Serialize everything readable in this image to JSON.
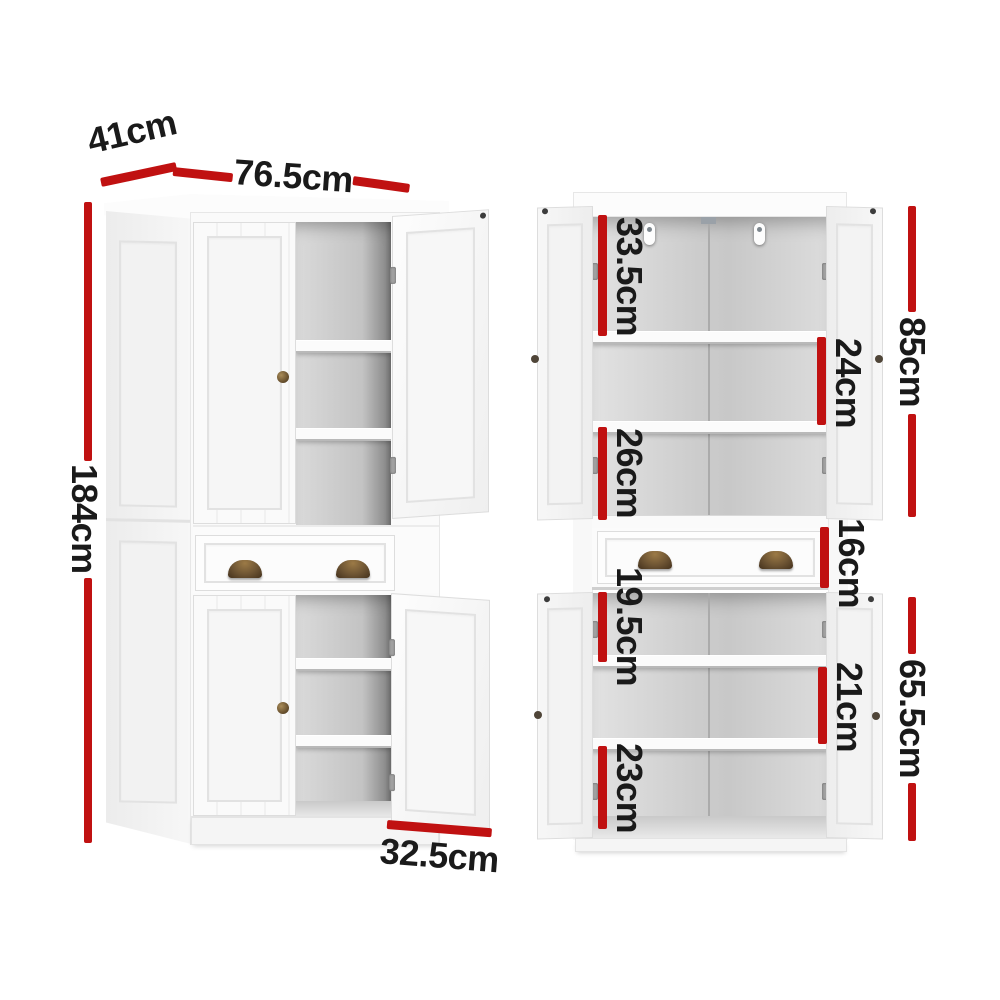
{
  "colors": {
    "annotation_red": "#c01111",
    "label_text": "#1a1a1a",
    "cabinet_white": "#fafafa",
    "interior_grey": "#cccccc",
    "handle_bronze": "#6d5433"
  },
  "angled_view": {
    "depth": "41cm",
    "width": "76.5cm",
    "height": "184cm",
    "door_width": "32.5cm"
  },
  "front_view": {
    "upper_shelf_1": "33.5cm",
    "upper_shelf_2": "24cm",
    "upper_shelf_3": "26cm",
    "upper_section": "85cm",
    "drawer": "16cm",
    "lower_shelf_1": "19.5cm",
    "lower_shelf_2": "21cm",
    "lower_shelf_3": "23cm",
    "lower_section": "65.5cm"
  }
}
